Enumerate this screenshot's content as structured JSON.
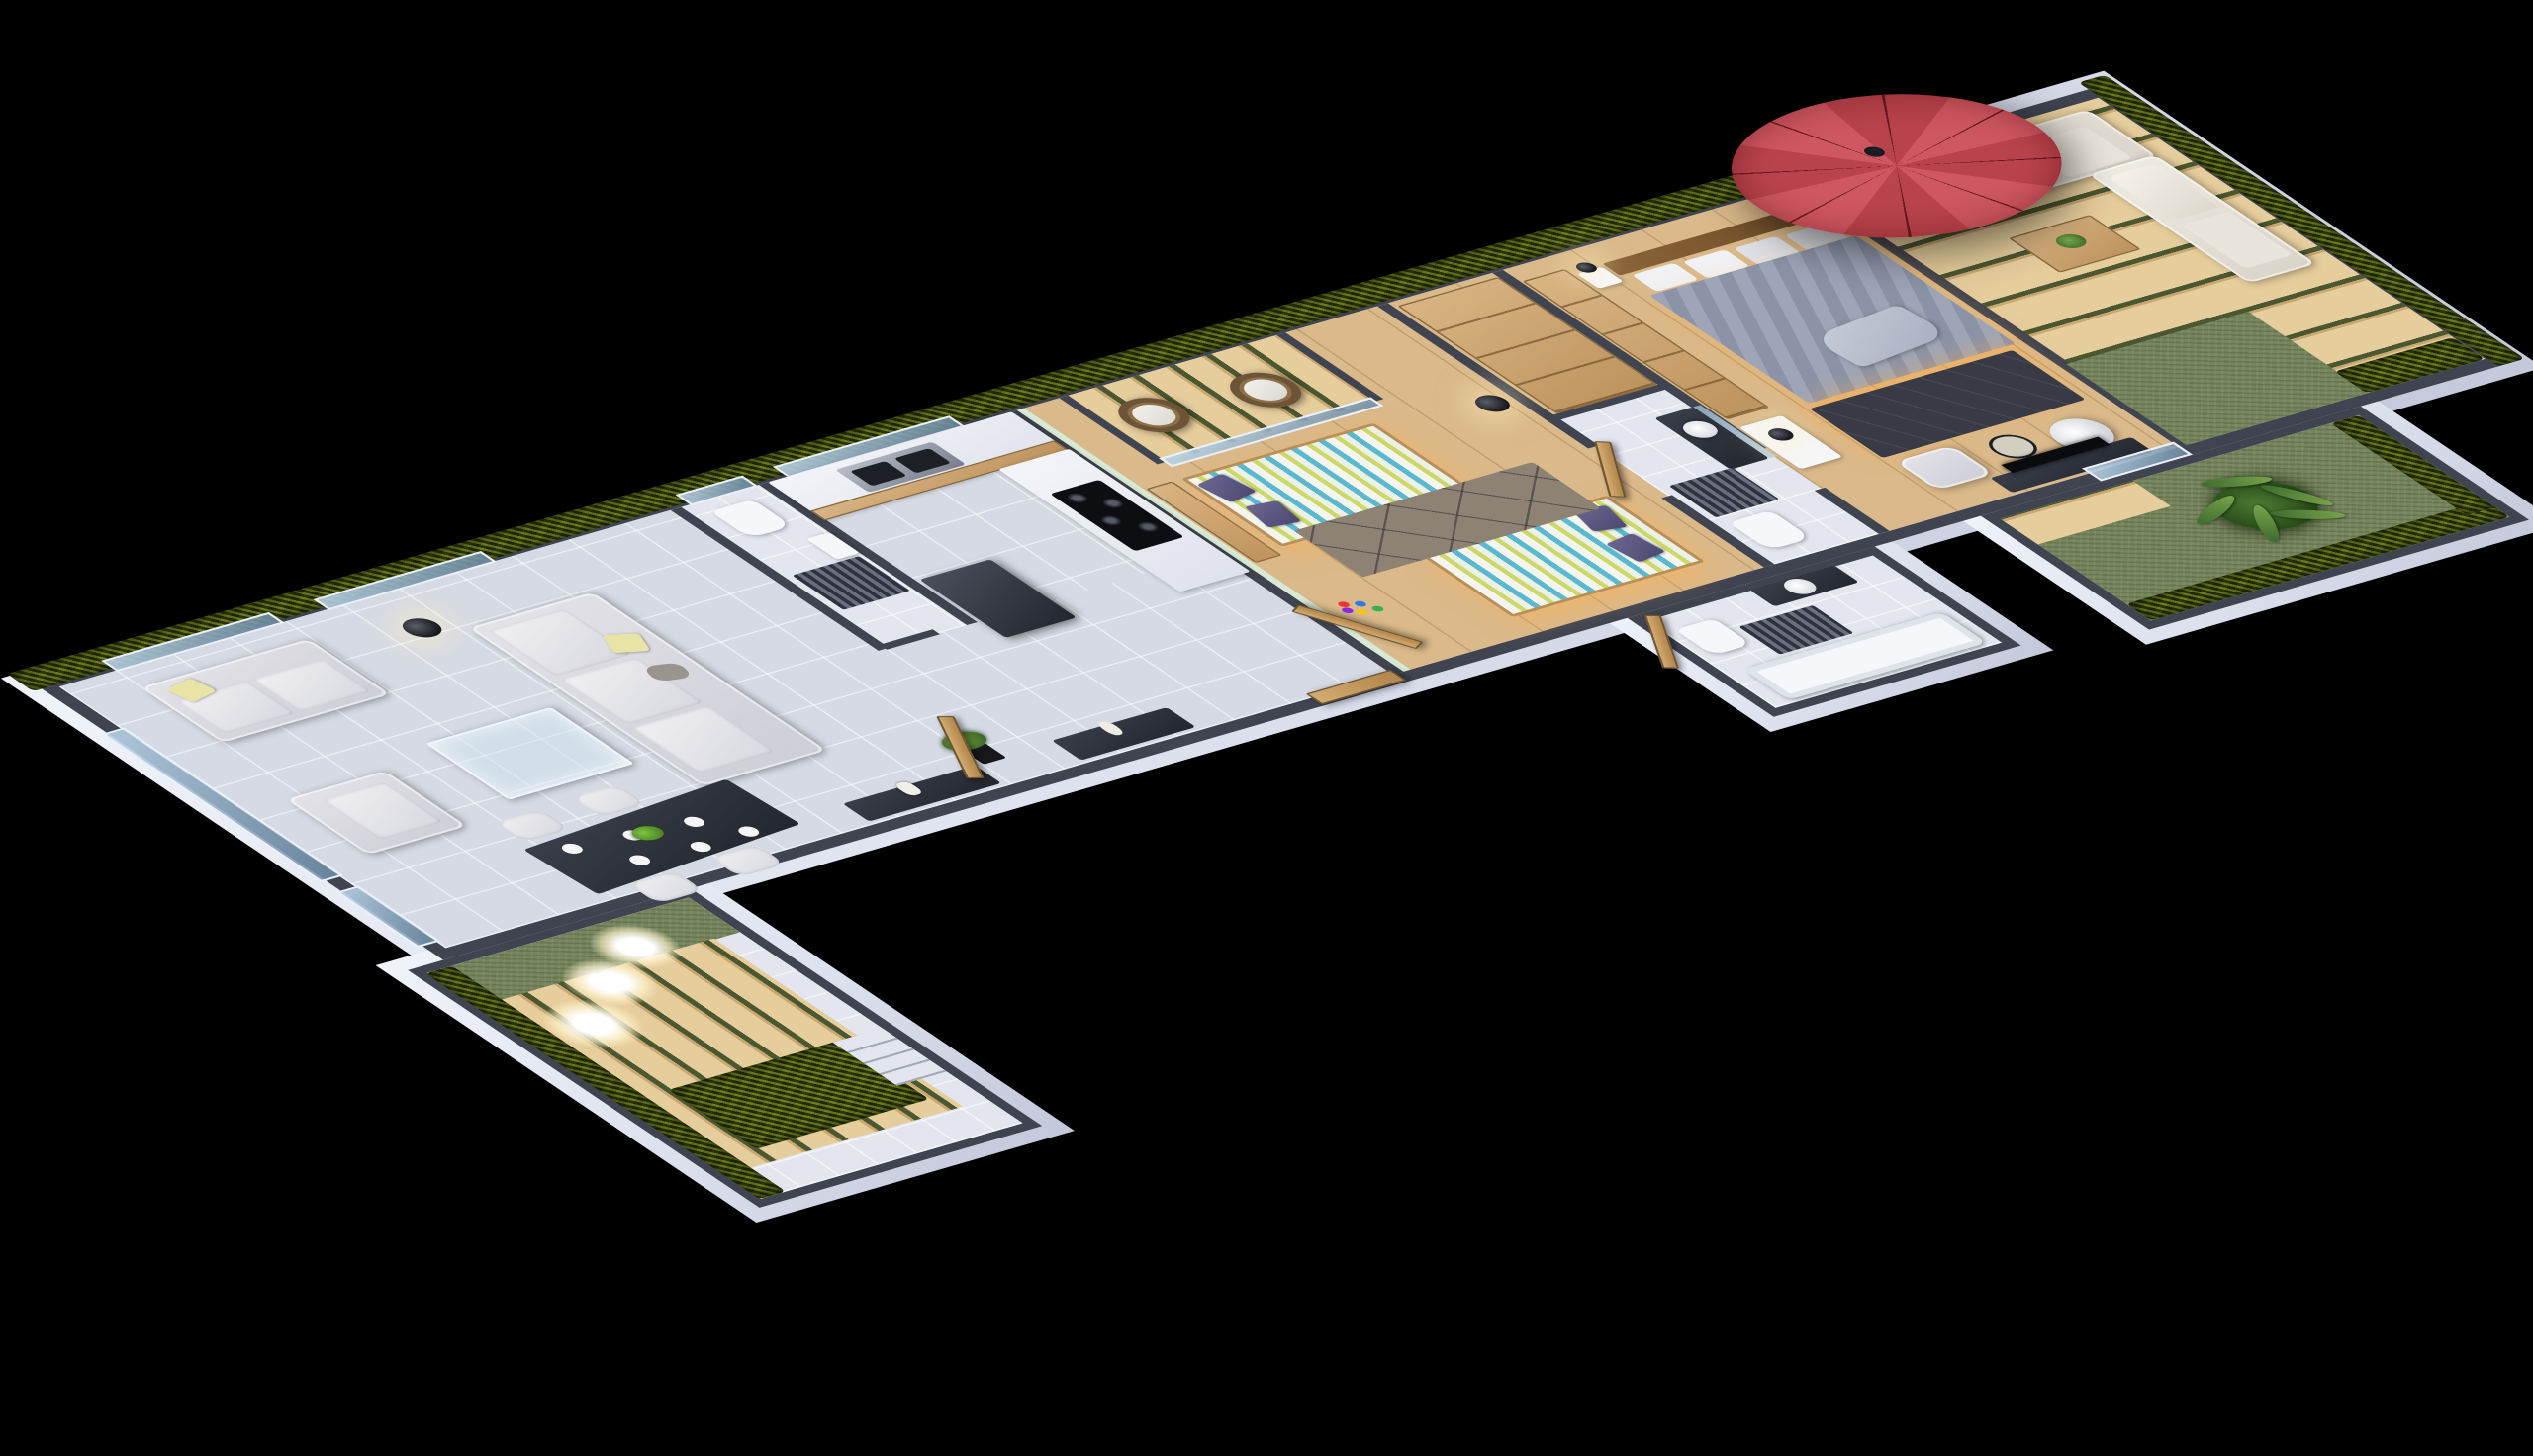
{
  "meta": {
    "scene": "isometric-3d-apartment-floor-plan",
    "style": "night render, black background, cutaway walls",
    "text_visible_on_screen": ""
  },
  "palette": {
    "bg": "#000000",
    "wallTop": "#3f4450",
    "wallWhite": "#e7eaf4",
    "floorTile": "#d6dae4",
    "wood": "#dab98a",
    "deck": "#e6cd9c",
    "deckGap": "#4a5730",
    "hedge": "#4c5917",
    "grass": "#75855c",
    "mint": "#d8e9d5",
    "sofa": "#d8d8de",
    "cushionYellow": "#e9e3a6",
    "purple": "#585478",
    "stripeGreen": "#ccd968",
    "stripeBlue": "#5ab8cf",
    "duvetGray": "#939bae",
    "charcoal": "#23262e",
    "rugTaupe": "#8d8274",
    "umbrellaRed": "#c14b55",
    "doorWood": "#c49a62",
    "glow": "#fff3cc"
  },
  "rooms": [
    {
      "id": "left-terrace",
      "label": "Lower Terrace",
      "features": [
        "vertical wood deck",
        "hedge planters",
        "three glowing globe lamps",
        "grass strip",
        "tiled patio with steps"
      ]
    },
    {
      "id": "living-dining",
      "label": "Living and Dining Room",
      "features": [
        "loveseat",
        "three-seat sofa",
        "armchair",
        "glass coffee table",
        "floor lamp",
        "dark dining table set for four",
        "console with vase",
        "potted plant"
      ]
    },
    {
      "id": "wc",
      "label": "Guest WC",
      "features": [
        "toilet",
        "wall basin",
        "striped rug",
        "window"
      ]
    },
    {
      "id": "kitchen",
      "label": "Kitchen",
      "features": [
        "L-shaped counter",
        "double sink",
        "four-zone cooktop",
        "dark fridge"
      ]
    },
    {
      "id": "hallway",
      "label": "Entry Hall",
      "features": [
        "entry door",
        "console bench with vase"
      ]
    },
    {
      "id": "kids-bedroom",
      "label": "Kids Bedroom",
      "features": [
        "two single beds with striped bedding",
        "purple pillows",
        "toy blocks",
        "tripod floor lamp",
        "geometric rug",
        "mint accent wall",
        "balcony with two rattan chairs"
      ]
    },
    {
      "id": "bathroom",
      "label": "Shower Bathroom",
      "features": [
        "round basin vanity",
        "mirror",
        "toilet",
        "striped rug",
        "wood door"
      ]
    },
    {
      "id": "family-bathroom",
      "label": "Family Bathroom",
      "features": [
        "bathtub",
        "toilet",
        "round basin vanity",
        "striped rug",
        "wood door"
      ]
    },
    {
      "id": "master-bedroom",
      "label": "Master Bedroom",
      "features": [
        "double bed with gray striped duvet",
        "wood headboard",
        "open wardrobes",
        "desk with black lamp",
        "dark rug with underbed glow",
        "armchair",
        "round glass table",
        "white egg chair",
        "TV console",
        "glass door to garden"
      ]
    },
    {
      "id": "roof-terrace",
      "label": "Roof Terrace",
      "features": [
        "red cantilever umbrella",
        "L-shaped cream sofa",
        "wood block coffee table with plant",
        "plank deck",
        "grass patch",
        "hedge parapet"
      ]
    },
    {
      "id": "garden",
      "label": "Garden",
      "features": [
        "lawn",
        "fan palm",
        "hedge borders",
        "deck strips"
      ]
    }
  ]
}
